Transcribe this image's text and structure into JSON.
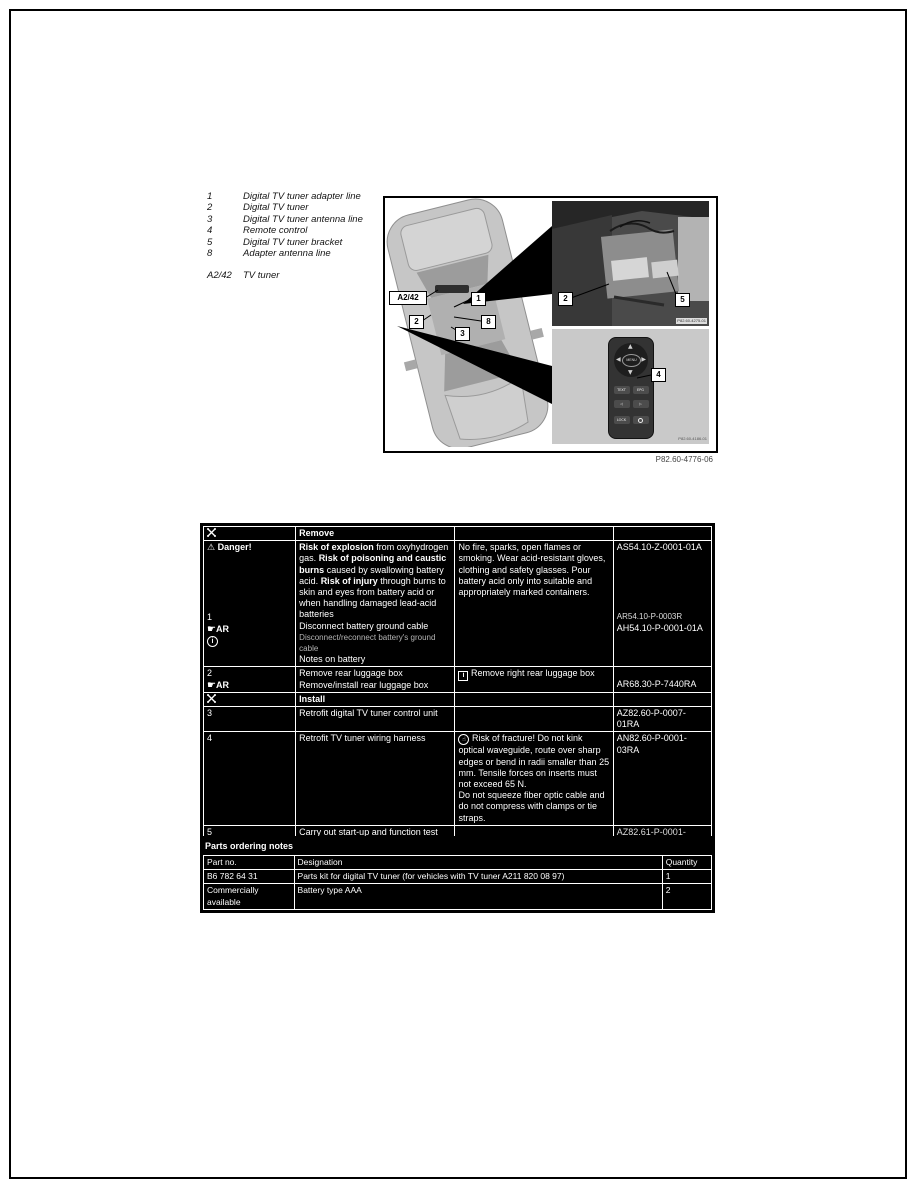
{
  "legend": {
    "items": [
      {
        "key": "1",
        "label": "Digital TV tuner adapter line"
      },
      {
        "key": "2",
        "label": "Digital TV tuner"
      },
      {
        "key": "3",
        "label": "Digital TV tuner antenna line"
      },
      {
        "key": "4",
        "label": "Remote control"
      },
      {
        "key": "5",
        "label": "Digital TV tuner bracket"
      },
      {
        "key": "8",
        "label": "Adapter antenna line"
      }
    ],
    "module_key": "A2/42",
    "module_label": "TV tuner"
  },
  "figure": {
    "caption": "P82.60-4776-06",
    "car": {
      "module_tag": "A2/42",
      "callout_1": "1",
      "callout_2": "2",
      "callout_8": "8",
      "callout_3": "3"
    },
    "tuner_photo": {
      "callout_2": "2",
      "callout_5": "5",
      "caption": "P82.60-4275-01"
    },
    "remote_photo": {
      "callout_4": "4",
      "caption": "P82.60-4186-01",
      "buttons": {
        "menu": "MENU",
        "text": "TEXT",
        "epg": "EPG",
        "lock": "LOCK"
      }
    }
  },
  "procedure_table": {
    "remove_header": "Remove",
    "install_header": "Install",
    "danger": {
      "label": "Danger!",
      "risk_bold_1": "Risk of explosion",
      "risk_text_1": " from oxyhydrogen gas. ",
      "risk_bold_2": "Risk of poisoning and caustic burns",
      "risk_text_2": " caused by swallowing battery acid. ",
      "risk_bold_3": "Risk of injury",
      "risk_text_3": " through burns to skin and eyes from battery acid or when handling damaged lead-acid batteries",
      "step_no": "1",
      "ar_label": "AR",
      "action": "Disconnect battery ground cable",
      "sub_action": "Disconnect/reconnect battery's ground cable",
      "note_link": "Notes on battery",
      "safety_note": "No fire, sparks, open flames or smoking. Wear acid-resistant gloves, clothing and safety glasses. Pour battery acid only into suitable and appropriately marked containers.",
      "code_1": "AS54.10-Z-0001-01A",
      "code_2": "AR54.10-P-0003R",
      "code_3": "AH54.10-P-0001-01A"
    },
    "step2": {
      "no": "2",
      "ar_label": "AR",
      "action_1": "Remove rear luggage box",
      "action_2": "Remove/install rear luggage box",
      "note": "Remove right rear luggage box",
      "code": "AR68.30-P-7440RA"
    },
    "step3": {
      "no": "3",
      "action": "Retrofit digital TV tuner control unit",
      "code": "AZ82.60-P-0007-01RA"
    },
    "step4": {
      "no": "4",
      "action": "Retrofit TV tuner wiring harness",
      "note_1": "Risk of fracture! Do not kink optical waveguide, route over sharp edges or bend in radii smaller than 25 mm. Tensile forces on inserts must not exceed 65 N.",
      "note_2": "Do not squeeze fiber optic cable and do not compress with clamps or tie straps.",
      "code": "AN82.60-P-0001-03RA"
    },
    "step5": {
      "no": "5",
      "action": "Carry out start-up and function test",
      "code": "AZ82.61-P-0001-04MM"
    },
    "step6": {
      "no": "6",
      "action": "Install remaining parts onto vehicle"
    }
  },
  "parts_table": {
    "title": "Parts ordering notes",
    "headers": [
      "Part no.",
      "Designation",
      "Quantity"
    ],
    "rows": [
      {
        "part_no": "B6 782 64 31",
        "designation": "Parts kit for digital TV tuner (for vehicles with TV tuner A211 820 08 97)",
        "quantity": "1"
      },
      {
        "part_no": "Commercially available",
        "designation": "Battery type AAA",
        "quantity": "2"
      }
    ]
  }
}
